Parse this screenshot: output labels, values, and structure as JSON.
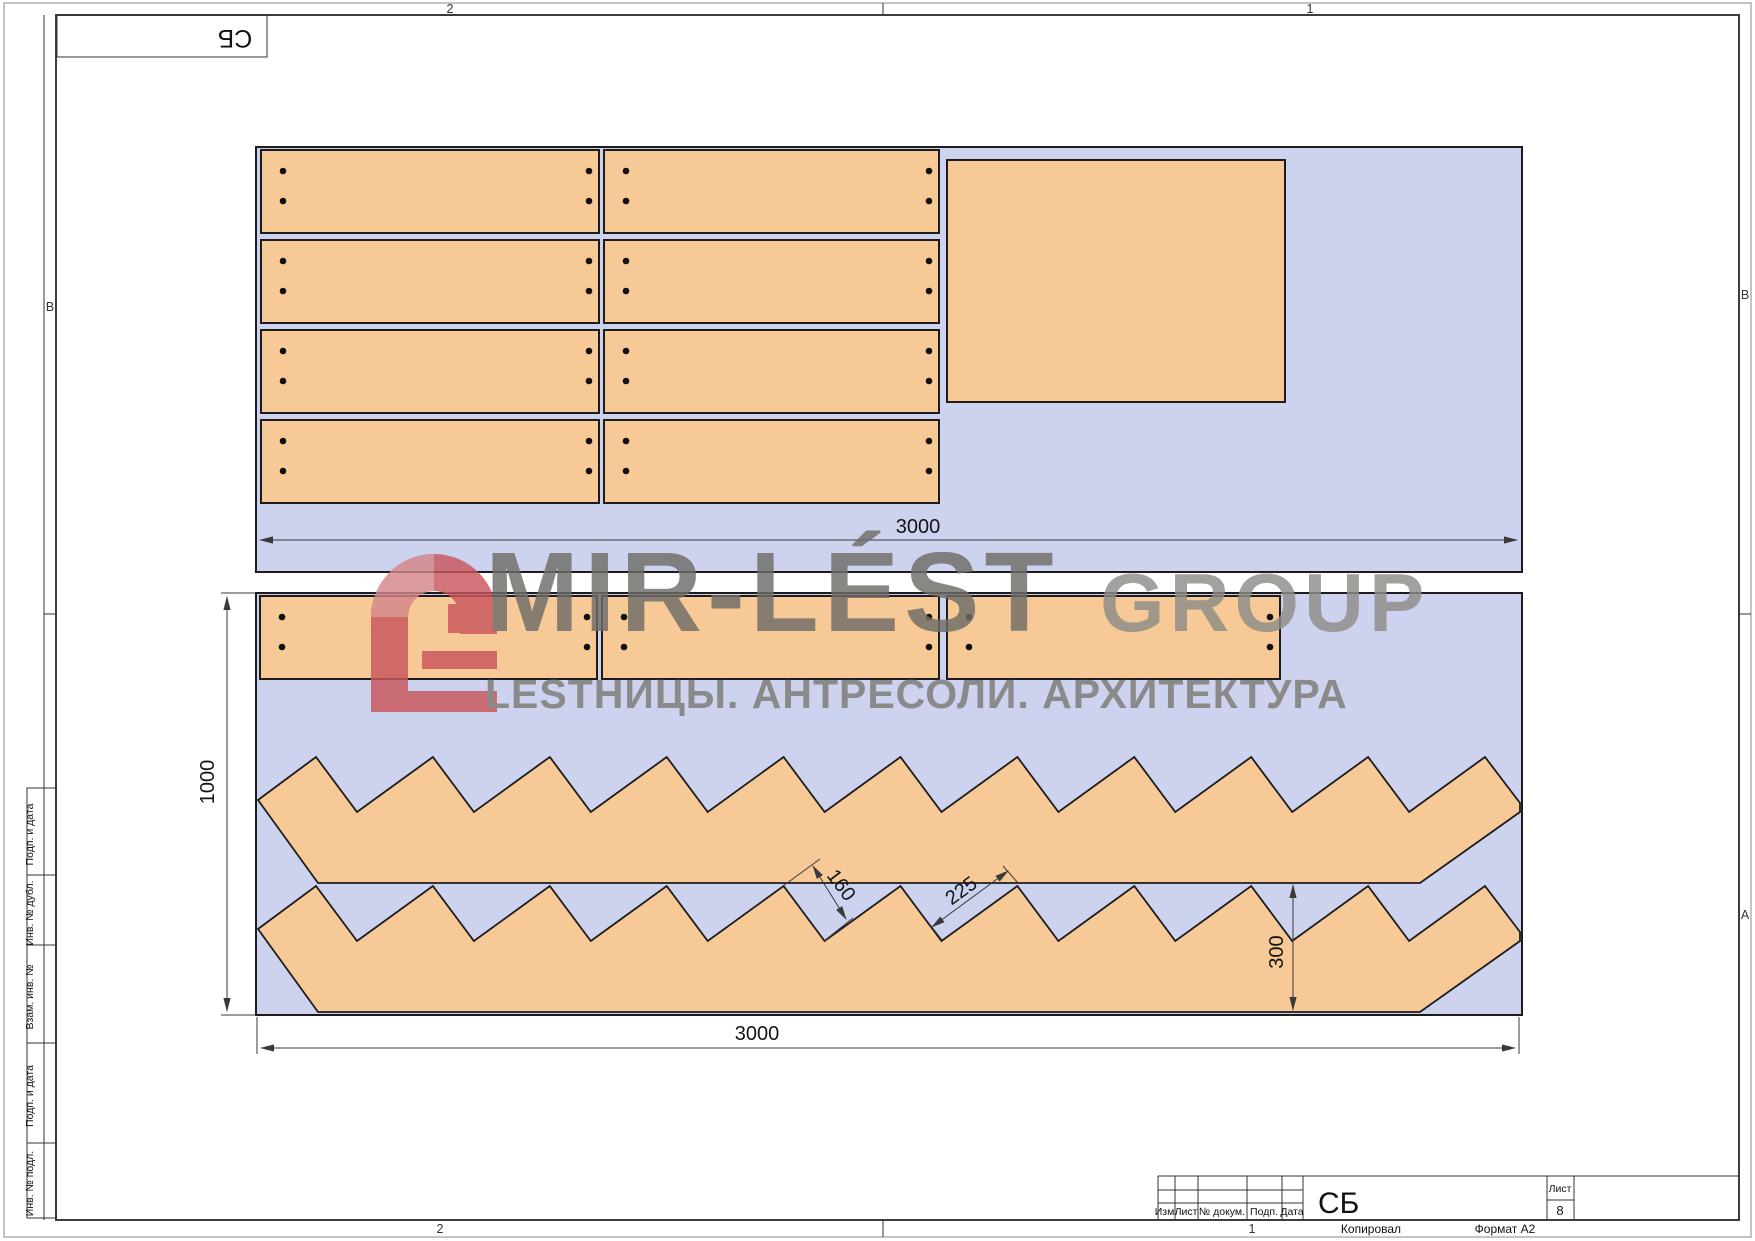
{
  "corner_stamp": "СБ",
  "zones": {
    "top_left": "2",
    "top_right": "1",
    "bottom_left": "2",
    "bottom_right": "1",
    "left_b": "B",
    "right_b": "B",
    "right_a": "A"
  },
  "sidebar": {
    "items": [
      {
        "label": "Подп. и дата"
      },
      {
        "label": "Инв. № дубл."
      },
      {
        "label": "Взам. инв. №"
      },
      {
        "label": "Подп. и дата"
      },
      {
        "label": "Инв. № подл."
      }
    ]
  },
  "watermark": {
    "brand": "MIR-LÉST",
    "brand_suffix": "GROUP",
    "tagline": "LESТНИЦЫ. АНТРЕСОЛИ. АРХИТЕКТУРА"
  },
  "dimensions": {
    "sheet1_width": "3000",
    "sheet2_width": "3000",
    "sheet2_height": "1000",
    "riser": "160",
    "tread": "225",
    "stringer_width": "300"
  },
  "title_block": {
    "doc_code": "СБ",
    "sheet_label": "Лист",
    "sheet_number": "8",
    "columns": [
      "Изм.",
      "Лист",
      "№ докум.",
      "Подп.",
      "Дата"
    ],
    "copied_label": "Копировал",
    "format_label": "Формат А2"
  },
  "colors": {
    "sheet_fill": "#cdd2ee",
    "panel_fill": "#f7c996",
    "outline": "#1c1c1c",
    "watermark_gray": "#6e6d68",
    "watermark_gray_light": "#8e8d89",
    "watermark_red": "#c9565c",
    "watermark_red_light": "#d4868a"
  }
}
